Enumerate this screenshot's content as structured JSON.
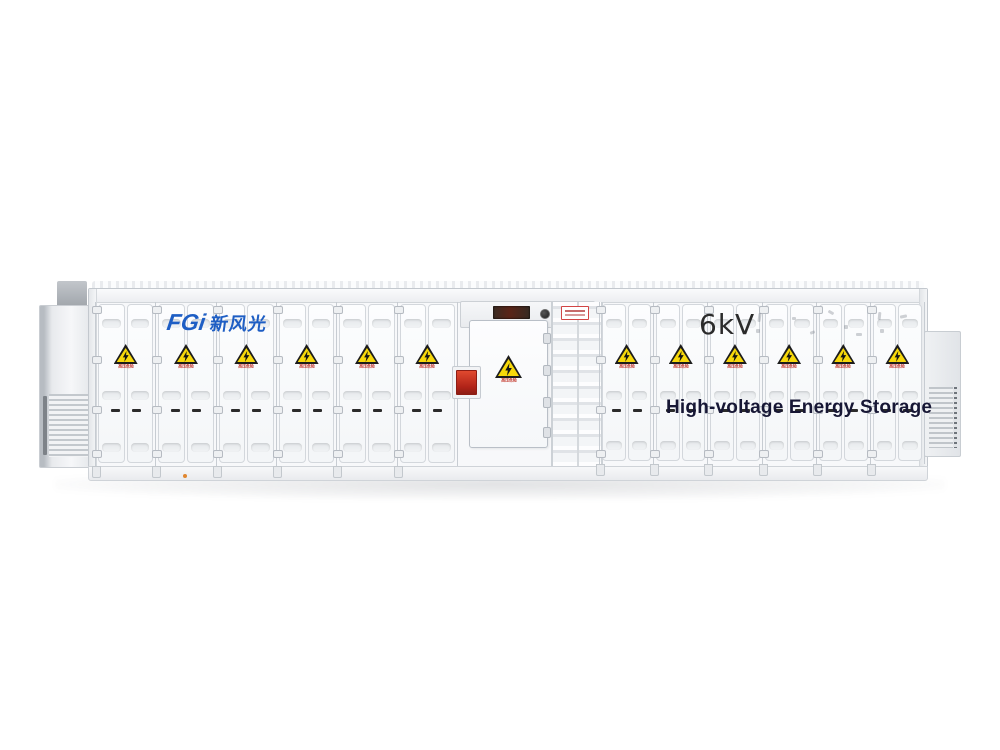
{
  "scene": {
    "type": "product-photo",
    "subject": "containerized high-voltage energy storage system",
    "background_color": "#ffffff"
  },
  "branding": {
    "logo_latin": "FGi",
    "logo_cjk": "新风光",
    "logo_color": "#1e5ec4"
  },
  "markings": {
    "voltage_label": "6kV",
    "voltage_label_color": "#2b2b2b",
    "product_title": "High-voltage Energy Storage",
    "product_title_color": "#171735",
    "hazard_caption": "高压危险",
    "hazard_caption_color": "#c43a2e"
  },
  "hazard_sign": {
    "shape": "warning-triangle",
    "fill_color": "#f7d80a",
    "border_color": "#1c1c1c",
    "symbol": "lightning-bolt"
  },
  "structure": {
    "left_module_count": 6,
    "right_module_count": 6,
    "has_personnel_door": true,
    "has_fire_alarm_box": true,
    "alarm_box_color": "#b02318",
    "has_cable_tray": true,
    "has_led_display": true,
    "end_units": [
      "left-hvac-louver-unit",
      "right-louver-vent-unit"
    ]
  }
}
